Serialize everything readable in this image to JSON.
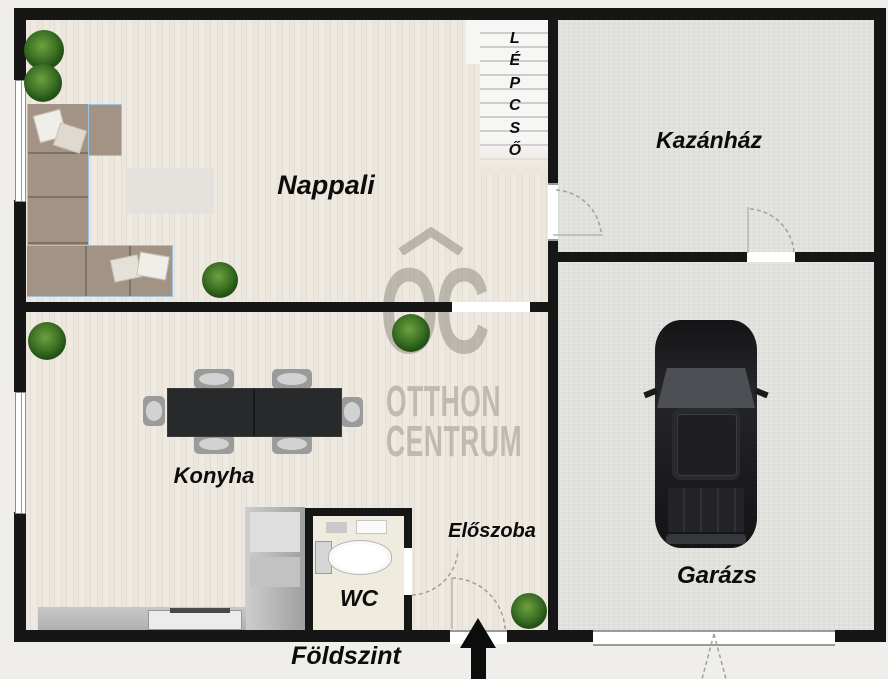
{
  "plan_title": "Földszint",
  "rooms": {
    "nappali": "Nappali",
    "kazanhaz": "Kazánház",
    "konyha": "Konyha",
    "wc": "WC",
    "eloszoba": "Előszoba",
    "garazs": "Garázs",
    "lepcso": "LÉPCSŐ"
  },
  "watermark": {
    "monogram": "OC",
    "line1": "OTTHON",
    "line2": "CENTRUM"
  },
  "colors": {
    "wall": "#161616",
    "wood_floor": "#ece7de",
    "concrete_floor": "#e5e5e2",
    "wc_floor": "#efecdf",
    "sofa": "#a29384",
    "table": "#28292b",
    "car_body": "#1c1c1f",
    "plant_green": "#3c7024",
    "watermark_grey": "#928e85",
    "background": "#efeeea"
  }
}
